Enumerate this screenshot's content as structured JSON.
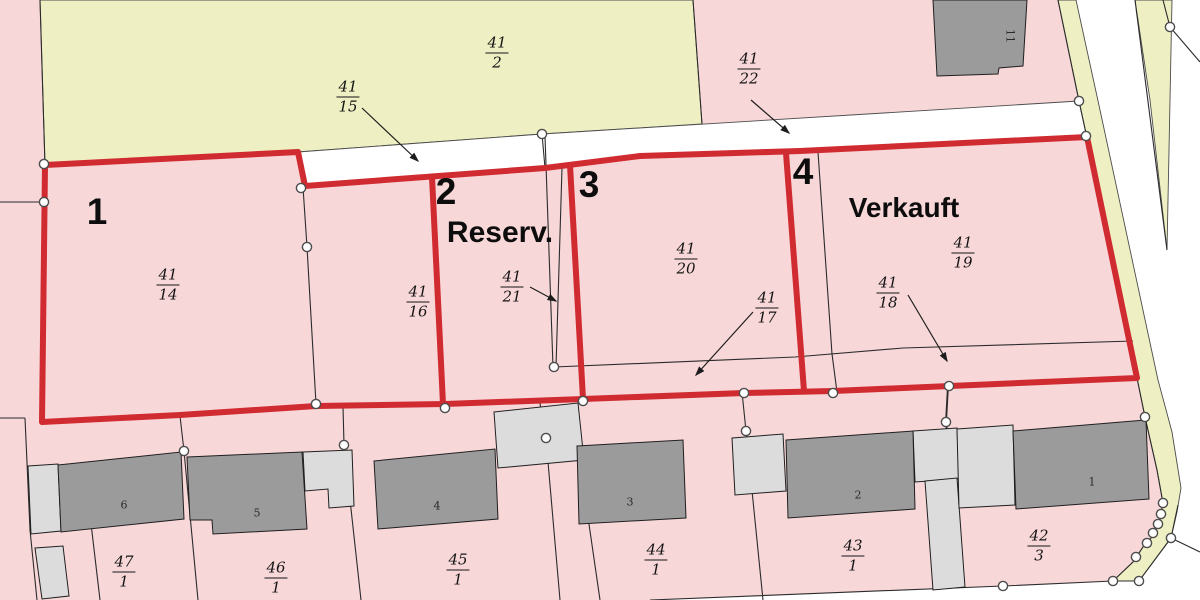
{
  "map": {
    "type": "cadastral-plot-map",
    "colors": {
      "parcel_pink": "#f8d7d9",
      "meadow_yellow": "#eeefc2",
      "road_white": "#ffffff",
      "building_dark": "#9b9b9b",
      "building_light": "#dcdcdc",
      "outline_red": "#cf2b30",
      "line_black": "#2b2b2b"
    },
    "fraction_labels": [
      {
        "num": "41",
        "den": "2",
        "x": 497,
        "y": 53
      },
      {
        "num": "41",
        "den": "22",
        "x": 749,
        "y": 69
      },
      {
        "num": "41",
        "den": "15",
        "x": 348,
        "y": 97
      },
      {
        "num": "41",
        "den": "14",
        "x": 168,
        "y": 285
      },
      {
        "num": "41",
        "den": "16",
        "x": 418,
        "y": 302
      },
      {
        "num": "41",
        "den": "21",
        "x": 512,
        "y": 287
      },
      {
        "num": "41",
        "den": "20",
        "x": 686,
        "y": 259
      },
      {
        "num": "41",
        "den": "17",
        "x": 767,
        "y": 308
      },
      {
        "num": "41",
        "den": "18",
        "x": 888,
        "y": 293
      },
      {
        "num": "41",
        "den": "19",
        "x": 963,
        "y": 253
      },
      {
        "num": "47",
        "den": "1",
        "x": 124,
        "y": 572
      },
      {
        "num": "46",
        "den": "1",
        "x": 276,
        "y": 578
      },
      {
        "num": "45",
        "den": "1",
        "x": 458,
        "y": 570
      },
      {
        "num": "44",
        "den": "1",
        "x": 656,
        "y": 560
      },
      {
        "num": "43",
        "den": "1",
        "x": 853,
        "y": 556
      },
      {
        "num": "42",
        "den": "3",
        "x": 1039,
        "y": 546
      }
    ],
    "plot_numbers": [
      {
        "label": "1",
        "x": 97,
        "y": 212
      },
      {
        "label": "2",
        "x": 446,
        "y": 192
      },
      {
        "label": "3",
        "x": 589,
        "y": 185
      },
      {
        "label": "4",
        "x": 803,
        "y": 172
      }
    ],
    "status_labels": [
      {
        "label": "Reserv.",
        "x": 500,
        "y": 233,
        "size": 30
      },
      {
        "label": "Verkauft",
        "x": 904,
        "y": 208,
        "size": 28
      }
    ],
    "building_numbers": [
      {
        "label": "6",
        "x": 124,
        "y": 505,
        "rot": 0
      },
      {
        "label": "5",
        "x": 257,
        "y": 513,
        "rot": 0
      },
      {
        "label": "4",
        "x": 437,
        "y": 506,
        "rot": 0
      },
      {
        "label": "3",
        "x": 630,
        "y": 502,
        "rot": 0
      },
      {
        "label": "2",
        "x": 858,
        "y": 495,
        "rot": 0
      },
      {
        "label": "1",
        "x": 1092,
        "y": 482,
        "rot": 0
      },
      {
        "label": "11",
        "x": 1010,
        "y": 36,
        "rot": 90
      }
    ]
  }
}
